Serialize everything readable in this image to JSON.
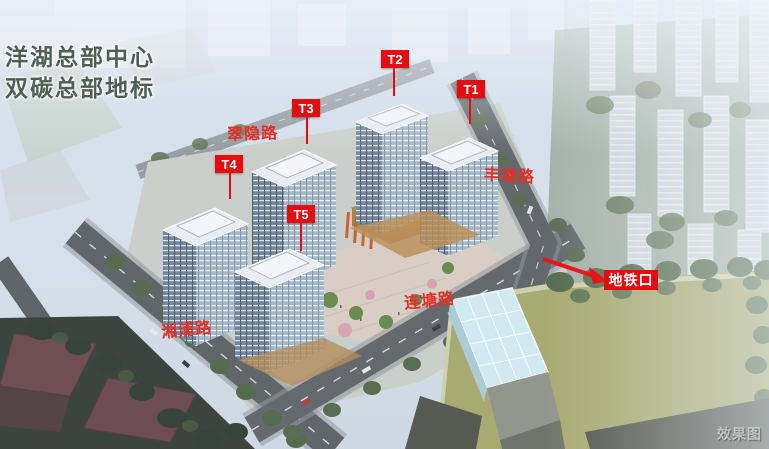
{
  "title": {
    "line1": "洋湖总部中心",
    "line2": "双碳总部地标"
  },
  "towers": [
    {
      "id": "T1",
      "label": "T1"
    },
    {
      "id": "T2",
      "label": "T2"
    },
    {
      "id": "T3",
      "label": "T3"
    },
    {
      "id": "T4",
      "label": "T4"
    },
    {
      "id": "T5",
      "label": "T5"
    }
  ],
  "roads": [
    {
      "name": "翠隐路"
    },
    {
      "name": "丰塘路"
    },
    {
      "name": "连塘路"
    },
    {
      "name": "湘浦路"
    }
  ],
  "metro": {
    "label": "地铁口"
  },
  "watermark": "效果图",
  "colors": {
    "annotation_red": "#e50b0f",
    "title_green": "#4e6056",
    "field_green": "#a4a76a",
    "glass_blue": "#cfeaef"
  }
}
